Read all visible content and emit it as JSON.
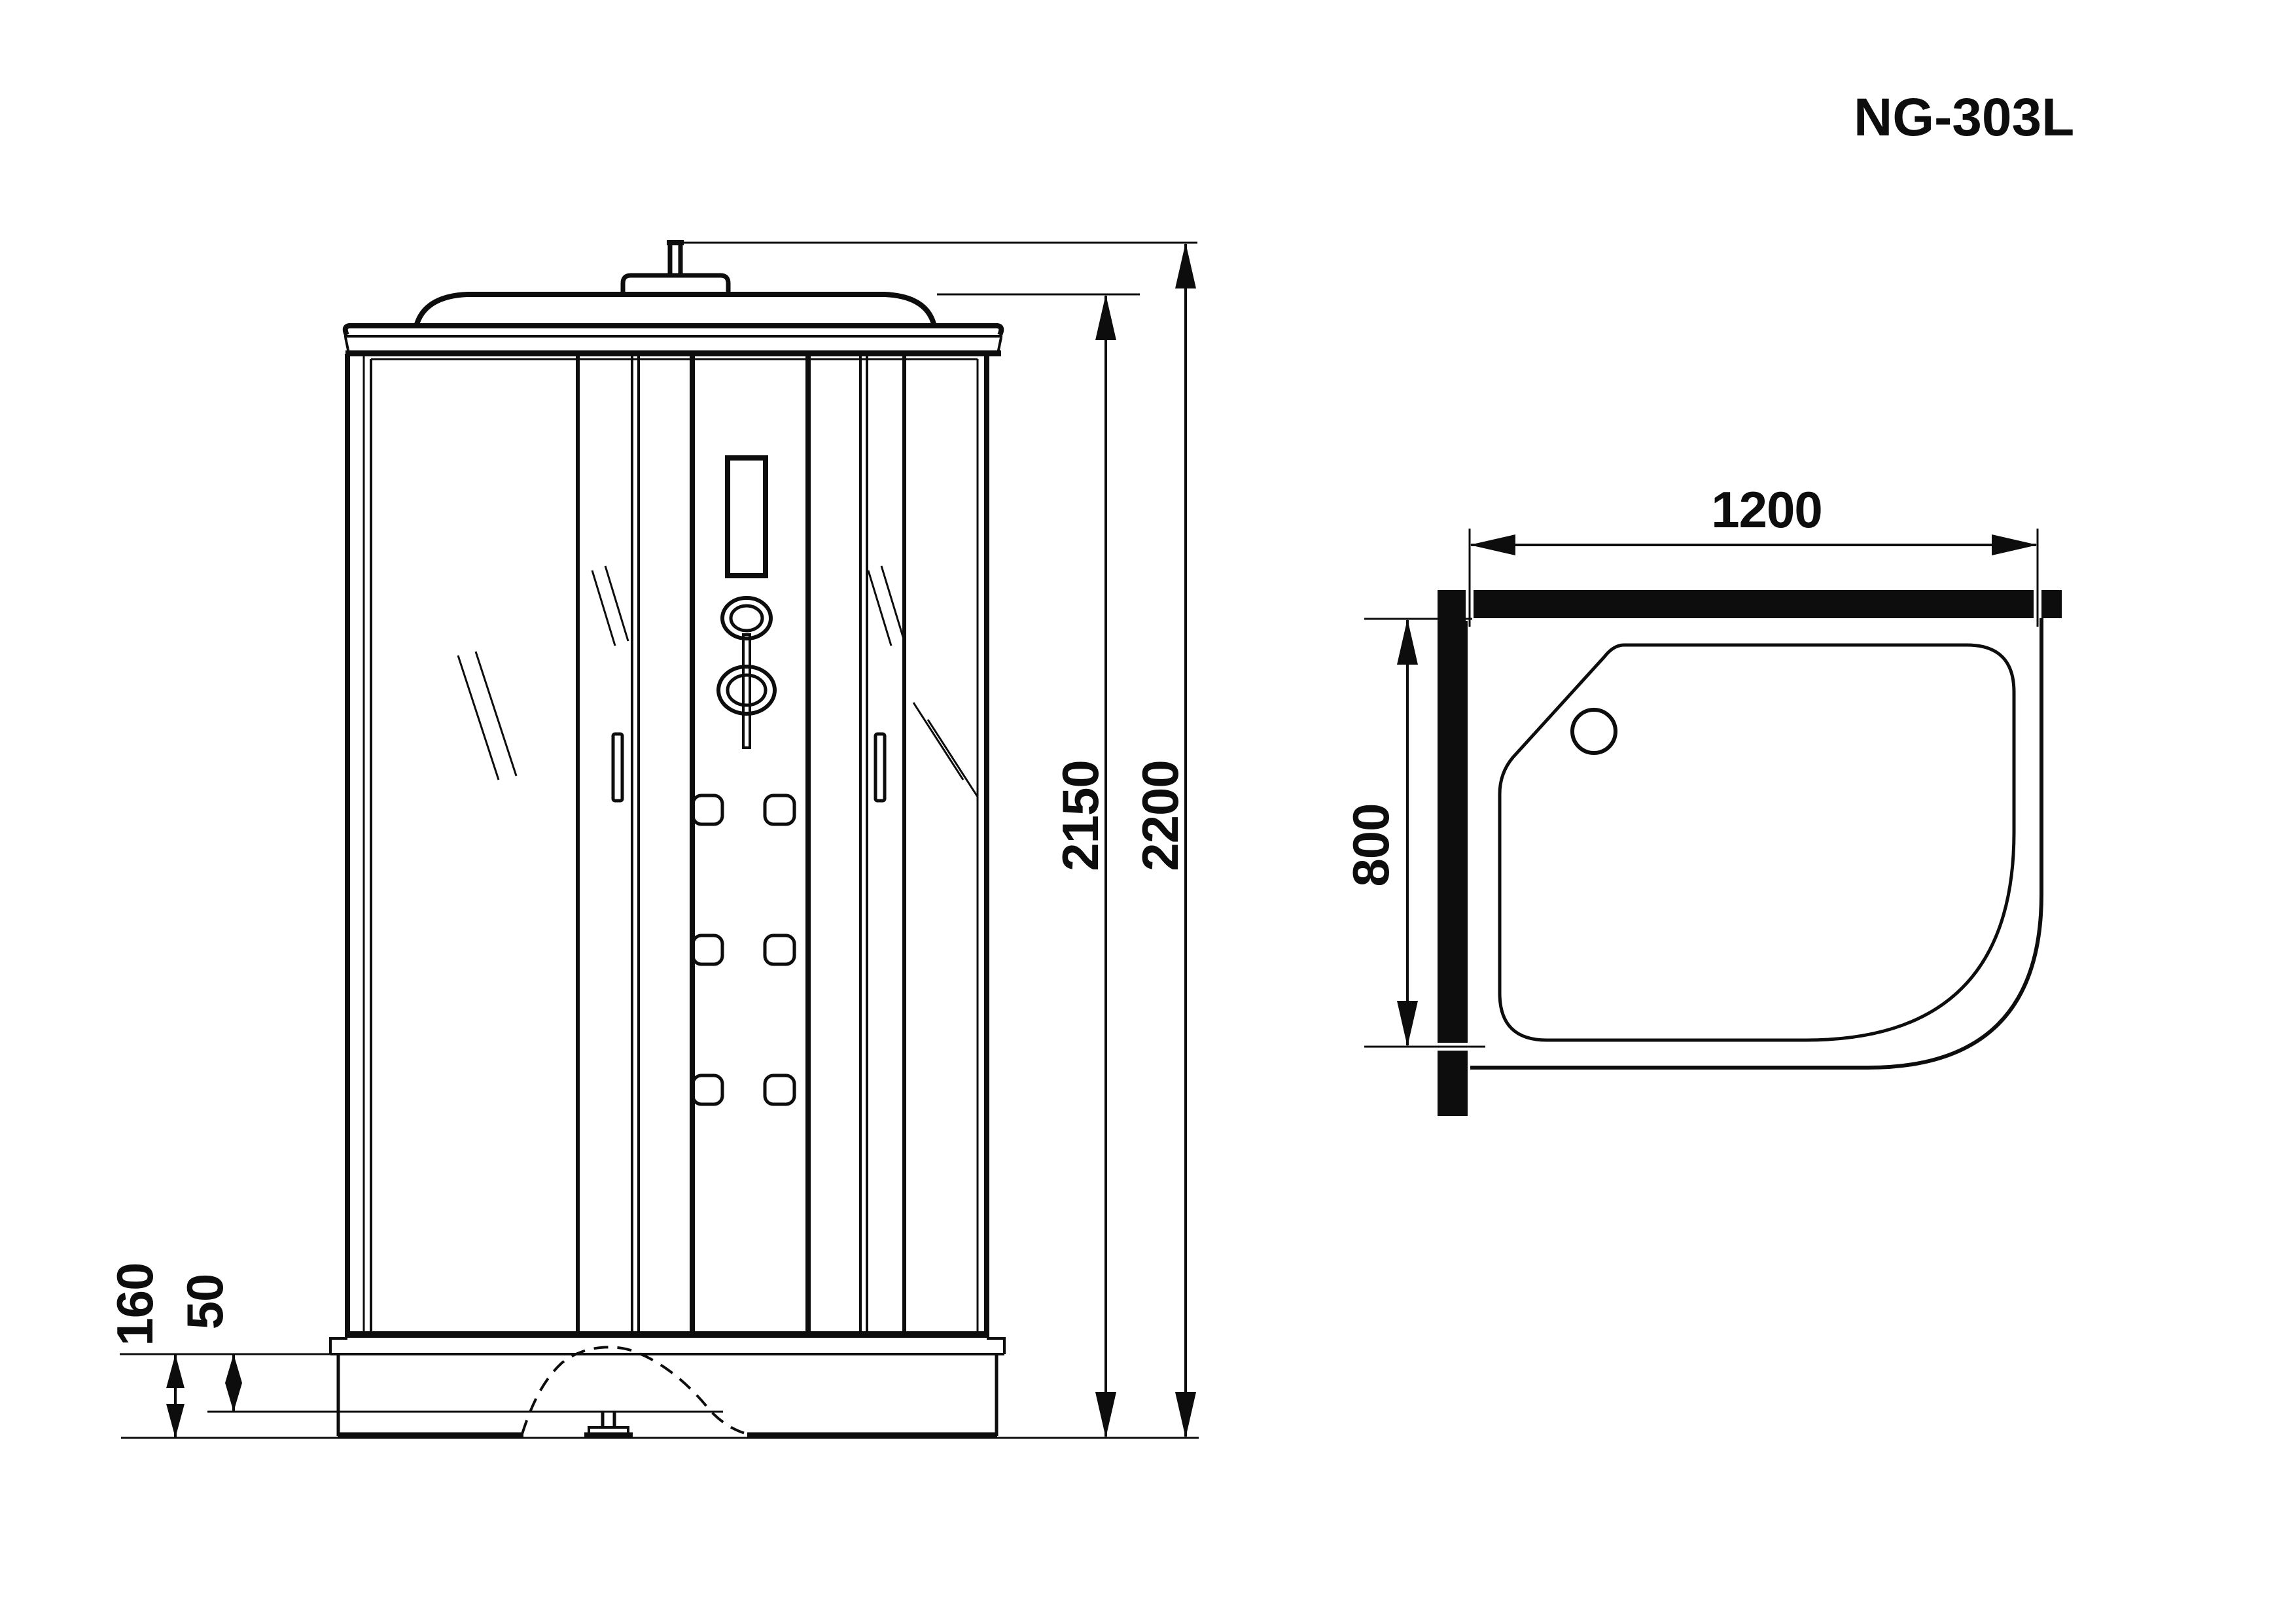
{
  "title": {
    "model_label": "NG-303L"
  },
  "front_view": {
    "description": "front elevation of shower cabin",
    "dimensions": {
      "overall_height": "2200",
      "cabin_height": "2150",
      "base_height": "160",
      "tray_step_height": "50"
    }
  },
  "plan_view": {
    "description": "top plan of asymmetric quarter-round shower tray, left-hand version",
    "dimensions": {
      "width": "1200",
      "depth": "800"
    }
  },
  "colors": {
    "line": "#0d0d0d",
    "background": "#ffffff",
    "solid_wall": "#0d0d0d"
  }
}
